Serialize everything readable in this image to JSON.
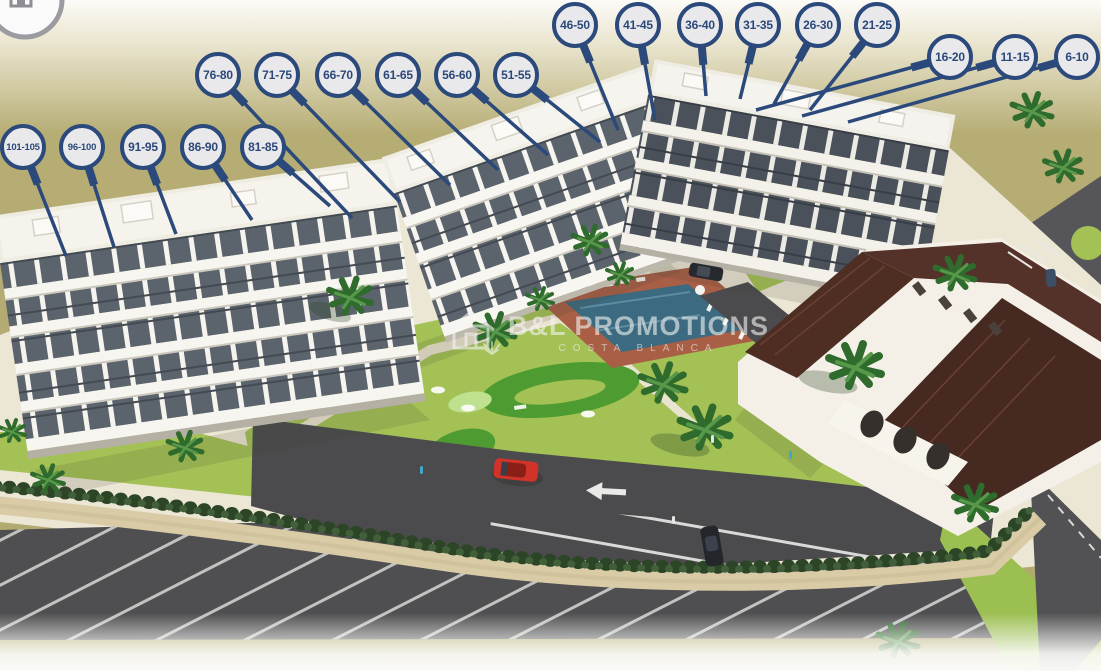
{
  "watermark": {
    "brand": "B&L PROMOTIONS",
    "tagline": "COSTA BLANCA"
  },
  "unit_labels": [
    {
      "range": "46-50"
    },
    {
      "range": "41-45"
    },
    {
      "range": "36-40"
    },
    {
      "range": "31-35"
    },
    {
      "range": "26-30"
    },
    {
      "range": "21-25"
    },
    {
      "range": "16-20"
    },
    {
      "range": "11-15"
    },
    {
      "range": "6-10"
    },
    {
      "range": "76-80"
    },
    {
      "range": "71-75"
    },
    {
      "range": "66-70"
    },
    {
      "range": "61-65"
    },
    {
      "range": "56-60"
    },
    {
      "range": "51-55"
    },
    {
      "range": "101-105"
    },
    {
      "range": "96-100"
    },
    {
      "range": "91-95"
    },
    {
      "range": "86-90"
    },
    {
      "range": "81-85"
    }
  ],
  "colors": {
    "accent_navy": "#2b497b",
    "marker_fill": "#e9e9ec",
    "field_olive": "#b6ad74",
    "lawn_green": "#a3c155",
    "minigolf_green": "#4e9c31",
    "pool_blue": "#3c6a80",
    "roof_brown": "#4a2b21",
    "asphalt": "#4b4b4d",
    "path_beige": "#d9cda9",
    "car_red": "#d23329"
  },
  "icons": {
    "corner_logo": "house-in-circle",
    "watermark_logo": "house-outline-with-palm",
    "road_arrow": "left-arrow-marking"
  }
}
